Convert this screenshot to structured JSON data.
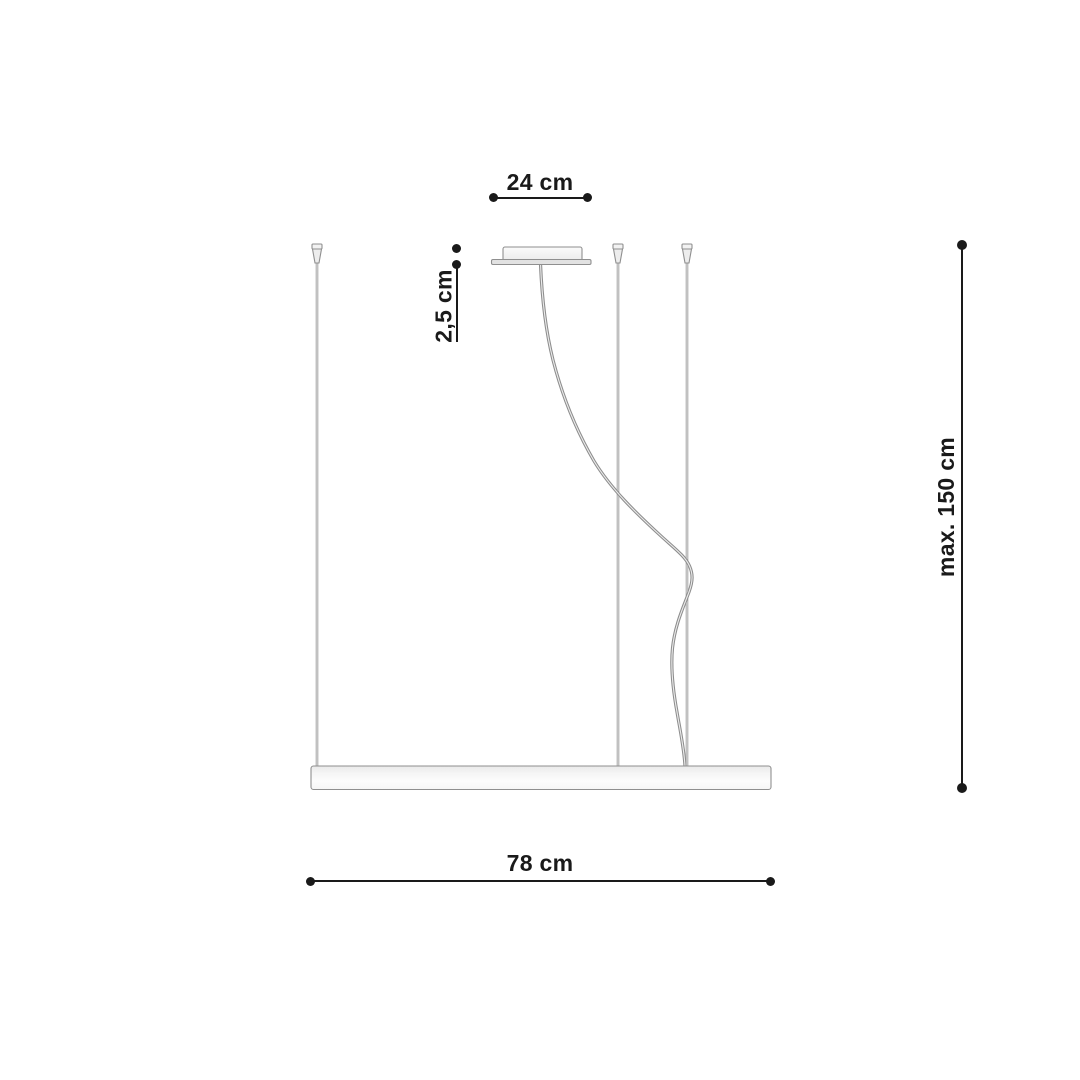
{
  "diagram": {
    "labels": {
      "canopy_width": "24 cm",
      "canopy_height": "2,5 cm",
      "suspension_max": "max. 150 cm",
      "bar_length": "78 cm"
    },
    "colors": {
      "dimension": "#1a1a1a",
      "wire": "#9e9e9e",
      "outline": "#8f8f8f",
      "fixture_fill": "#f4f4f4",
      "background": "#ffffff"
    }
  }
}
